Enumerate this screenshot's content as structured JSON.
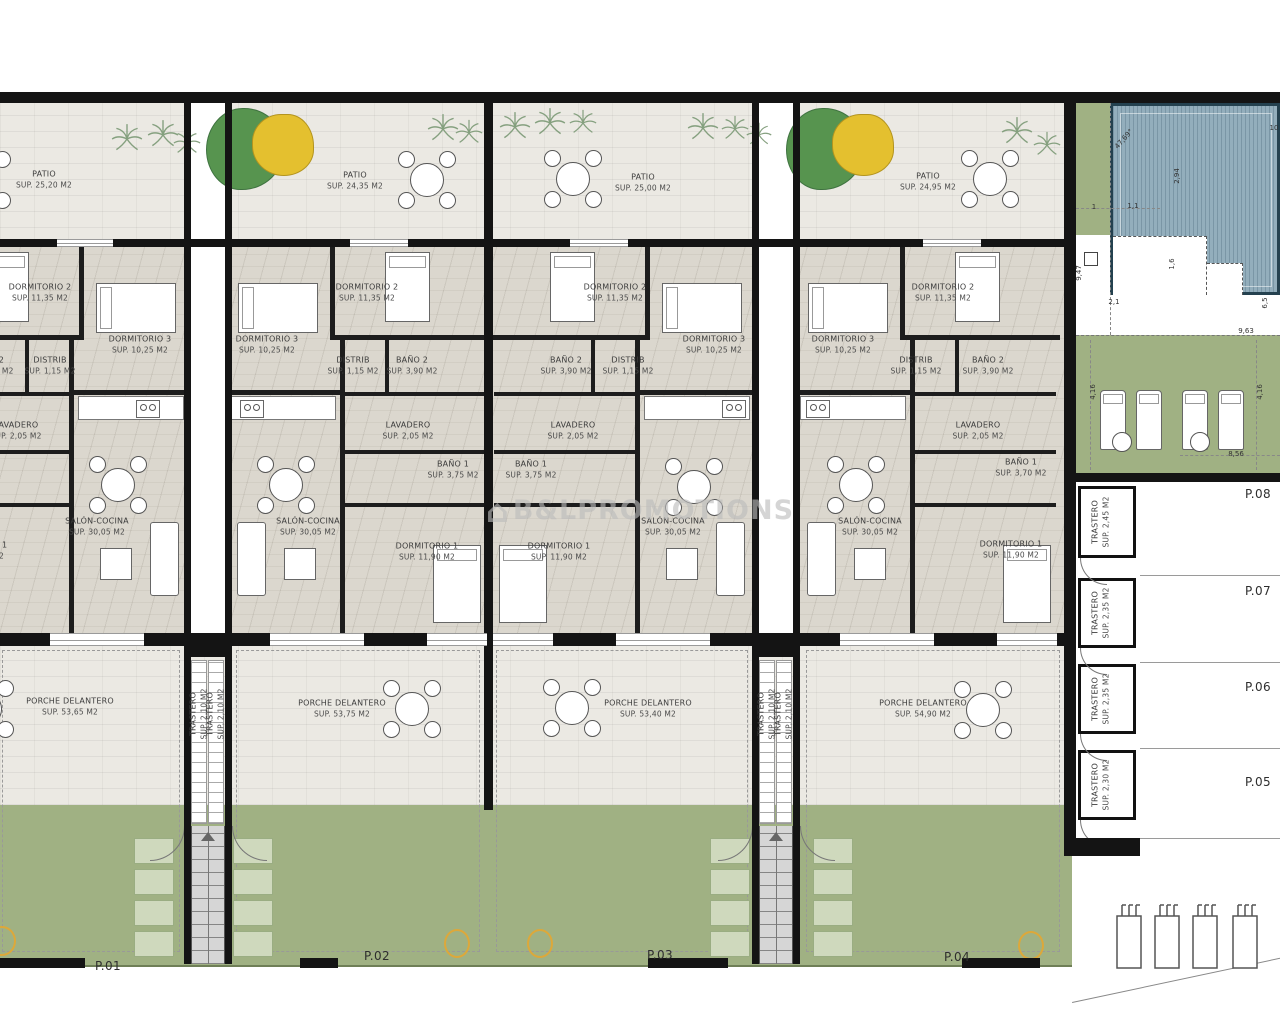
{
  "watermark": {
    "icon": "house",
    "icon_glyph": "⌂",
    "text": "B&LPROMOTIONS"
  },
  "units": [
    {
      "plot": "P.01",
      "patio_name": "PATIO",
      "patio_area": "SUP. 25,20 M2",
      "dorm2_name": "DORMITORIO 2",
      "dorm2_area": "SUP. 11,35 M2",
      "dorm3_name": "DORMITORIO 3",
      "dorm3_area": "SUP. 10,25 M2",
      "distrib_name": "DISTRIB",
      "distrib_area": "SUP. 1,15 M2",
      "bano2_name": "BAÑO 2",
      "bano2_area": "SUP. 3,90 M2",
      "lavadero_name": "LAVADERO",
      "lavadero_area": "SUP. 2,05 M2",
      "salon_name": "SALÓN-COCINA",
      "salon_area": "SUP. 30,05 M2",
      "dorm1_name": "DORMITORIO 1",
      "dorm1_area": "SUP. 11,90 M2",
      "porche_name": "PORCHE DELANTERO",
      "porche_area": "SUP. 53,65 M2"
    },
    {
      "plot": "P.02",
      "patio_name": "PATIO",
      "patio_area": "SUP. 24,35 M2",
      "dorm2_name": "DORMITORIO 2",
      "dorm2_area": "SUP. 11,35 M2",
      "dorm3_name": "DORMITORIO 3",
      "dorm3_area": "SUP. 10,25 M2",
      "distrib_name": "DISTRIB",
      "distrib_area": "SUP. 1,15 M2",
      "bano2_name": "BAÑO 2",
      "bano2_area": "SUP. 3,90 M2",
      "lavadero_name": "LAVADERO",
      "lavadero_area": "SUP. 2,05 M2",
      "bano1_name": "BAÑO 1",
      "bano1_area": "SUP. 3,75 M2",
      "salon_name": "SALÓN-COCINA",
      "salon_area": "SUP. 30,05 M2",
      "dorm1_name": "DORMITORIO 1",
      "dorm1_area": "SUP. 11,90 M2",
      "porche_name": "PORCHE DELANTERO",
      "porche_area": "SUP. 53,75 M2"
    },
    {
      "plot": "P.03",
      "patio_name": "PATIO",
      "patio_area": "SUP. 25,00 M2",
      "dorm2_name": "DORMITORIO 2",
      "dorm2_area": "SUP. 11,35 M2",
      "dorm3_name": "DORMITORIO 3",
      "dorm3_area": "SUP. 10,25 M2",
      "distrib_name": "DISTRIB",
      "distrib_area": "SUP. 1,15 M2",
      "bano2_name": "BAÑO 2",
      "bano2_area": "SUP. 3,90 M2",
      "lavadero_name": "LAVADERO",
      "lavadero_area": "SUP. 2,05 M2",
      "bano1_name": "BAÑO 1",
      "bano1_area": "SUP. 3,75 M2",
      "salon_name": "SALÓN-COCINA",
      "salon_area": "SUP. 30,05 M2",
      "dorm1_name": "DORMITORIO 1",
      "dorm1_area": "SUP. 11,90 M2",
      "porche_name": "PORCHE DELANTERO",
      "porche_area": "SUP. 53,40 M2"
    },
    {
      "plot": "P.04",
      "patio_name": "PATIO",
      "patio_area": "SUP. 24,95 M2",
      "dorm2_name": "DORMITORIO 2",
      "dorm2_area": "SUP. 11,35 M2",
      "dorm3_name": "DORMITORIO 3",
      "dorm3_area": "SUP. 10,25 M2",
      "distrib_name": "DISTRIB",
      "distrib_area": "SUP. 1,15 M2",
      "bano2_name": "BAÑO 2",
      "bano2_area": "SUP. 3,90 M2",
      "lavadero_name": "LAVADERO",
      "lavadero_area": "SUP. 2,05 M2",
      "bano1_name": "BAÑO 1",
      "bano1_area": "SUP. 3,70 M2",
      "salon_name": "SALÓN-COCINA",
      "salon_area": "SUP. 30,05 M2",
      "dorm1_name": "DORMITORIO 1",
      "dorm1_area": "SUP. 11,90 M2",
      "porche_name": "PORCHE DELANTERO",
      "porche_area": "SUP. 54,90 M2"
    }
  ],
  "center_trasteros": [
    {
      "name": "TRASTERO",
      "area": "SUP. 2,10 M2"
    },
    {
      "name": "TRASTERO",
      "area": "SUP. 2,10 M2"
    },
    {
      "name": "TRASTERO",
      "area": "SUP. 2,10 M2"
    },
    {
      "name": "TRASTERO",
      "area": "SUP. 2,10 M2"
    }
  ],
  "right_storage": [
    {
      "plot": "P.08",
      "name": "TRASTERO",
      "area": "SUP. 2,45 M2"
    },
    {
      "plot": "P.07",
      "name": "TRASTERO",
      "area": "SUP. 2,35 M2"
    },
    {
      "plot": "P.06",
      "name": "TRASTERO",
      "area": "SUP. 2,35 M2"
    },
    {
      "plot": "P.05",
      "name": "TRASTERO",
      "area": "SUP. 2,30 M2"
    }
  ],
  "dims": [
    "10",
    "47,69°",
    "2,94",
    "1",
    "1,1",
    "1,6",
    "9,47",
    "2,1",
    "6,5",
    "9,63",
    "4,16",
    "4,16",
    "8,56"
  ],
  "colors": {
    "garden_green": "#a0b183",
    "planter_green": "#cfd9bd",
    "pool_blue": "#93aebc",
    "tree_green": "#57944f",
    "tree_yellow": "#e4c02f",
    "accent_orange": "#dda83a",
    "wall_black": "#141414",
    "patio_tile": "#ebe9e3",
    "interior_floor": "#dbd7ce"
  }
}
